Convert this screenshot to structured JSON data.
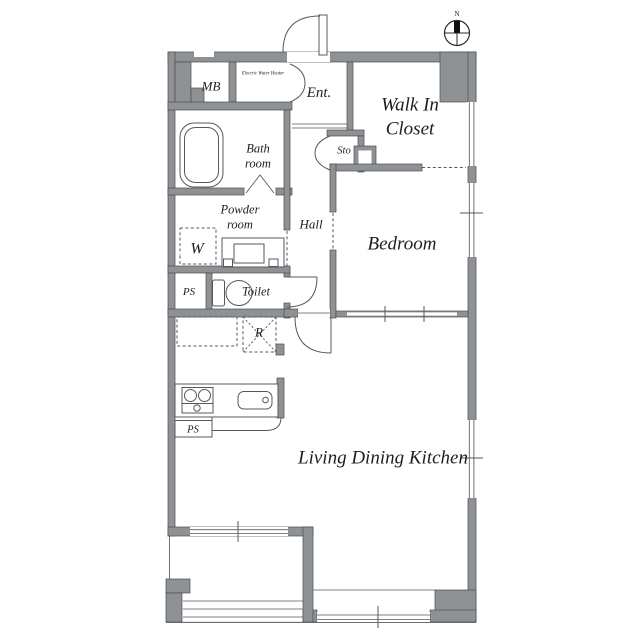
{
  "plan": {
    "compass": {
      "label": "N"
    },
    "rooms": {
      "mb": "MB",
      "water_heater": "Electric Water Heater",
      "entrance": "Ent.",
      "walk_in_closet_line1": "Walk In",
      "walk_in_closet_line2": "Closet",
      "bathroom_line1": "Bath",
      "bathroom_line2": "room",
      "storage": "Sto",
      "hall": "Hall",
      "powder_line1": "Powder",
      "powder_line2": "room",
      "washer": "W",
      "bedroom": "Bedroom",
      "pipe_space_1": "PS",
      "toilet": "Toilet",
      "refrigerator": "R",
      "pipe_space_2": "PS",
      "ldk": "Living Dining Kitchen"
    },
    "colors": {
      "wall": "#8f9294",
      "wallStroke": "#4b4e51",
      "line": "#55595c",
      "text": "#1e1e1e",
      "bg": "#ffffff"
    }
  }
}
